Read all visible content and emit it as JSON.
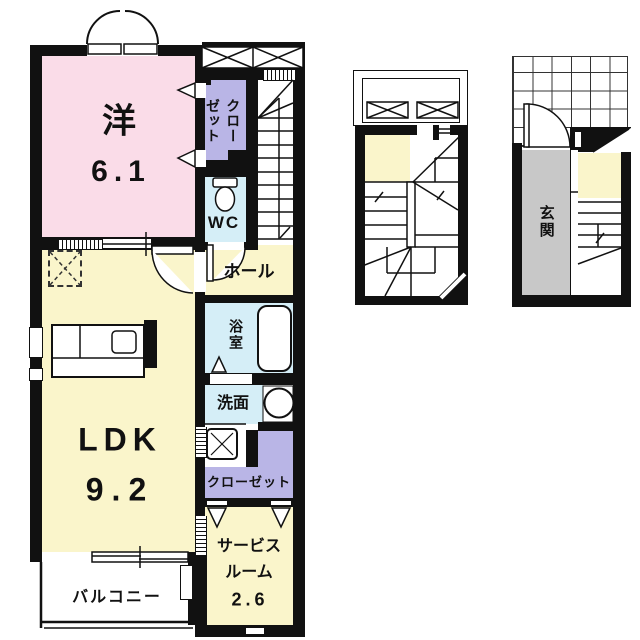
{
  "palette": {
    "wall": "#111111",
    "western_room": "#fadce8",
    "living_yellow": "#faf5cb",
    "wet_area_blue": "#d5eef7",
    "closet_purple": "#b9b5e6",
    "genkan_gray": "#c8c8c8"
  },
  "rooms": {
    "western": {
      "name": "洋",
      "area": "6.1"
    },
    "ldk": {
      "name": "LDK",
      "area": "9.2"
    },
    "closet_upper": {
      "name": "クロー\nゼット"
    },
    "wc": {
      "name": "WC"
    },
    "hall": {
      "name": "ホール"
    },
    "bath": {
      "name": "浴室"
    },
    "washroom": {
      "name": "洗面"
    },
    "closet_lower": {
      "name": "クローゼット"
    },
    "service": {
      "line1": "サービス",
      "line2": "ルーム",
      "area": "2.6"
    },
    "balcony": {
      "name": "バルコニー"
    },
    "genkan": {
      "name": "玄関"
    }
  }
}
